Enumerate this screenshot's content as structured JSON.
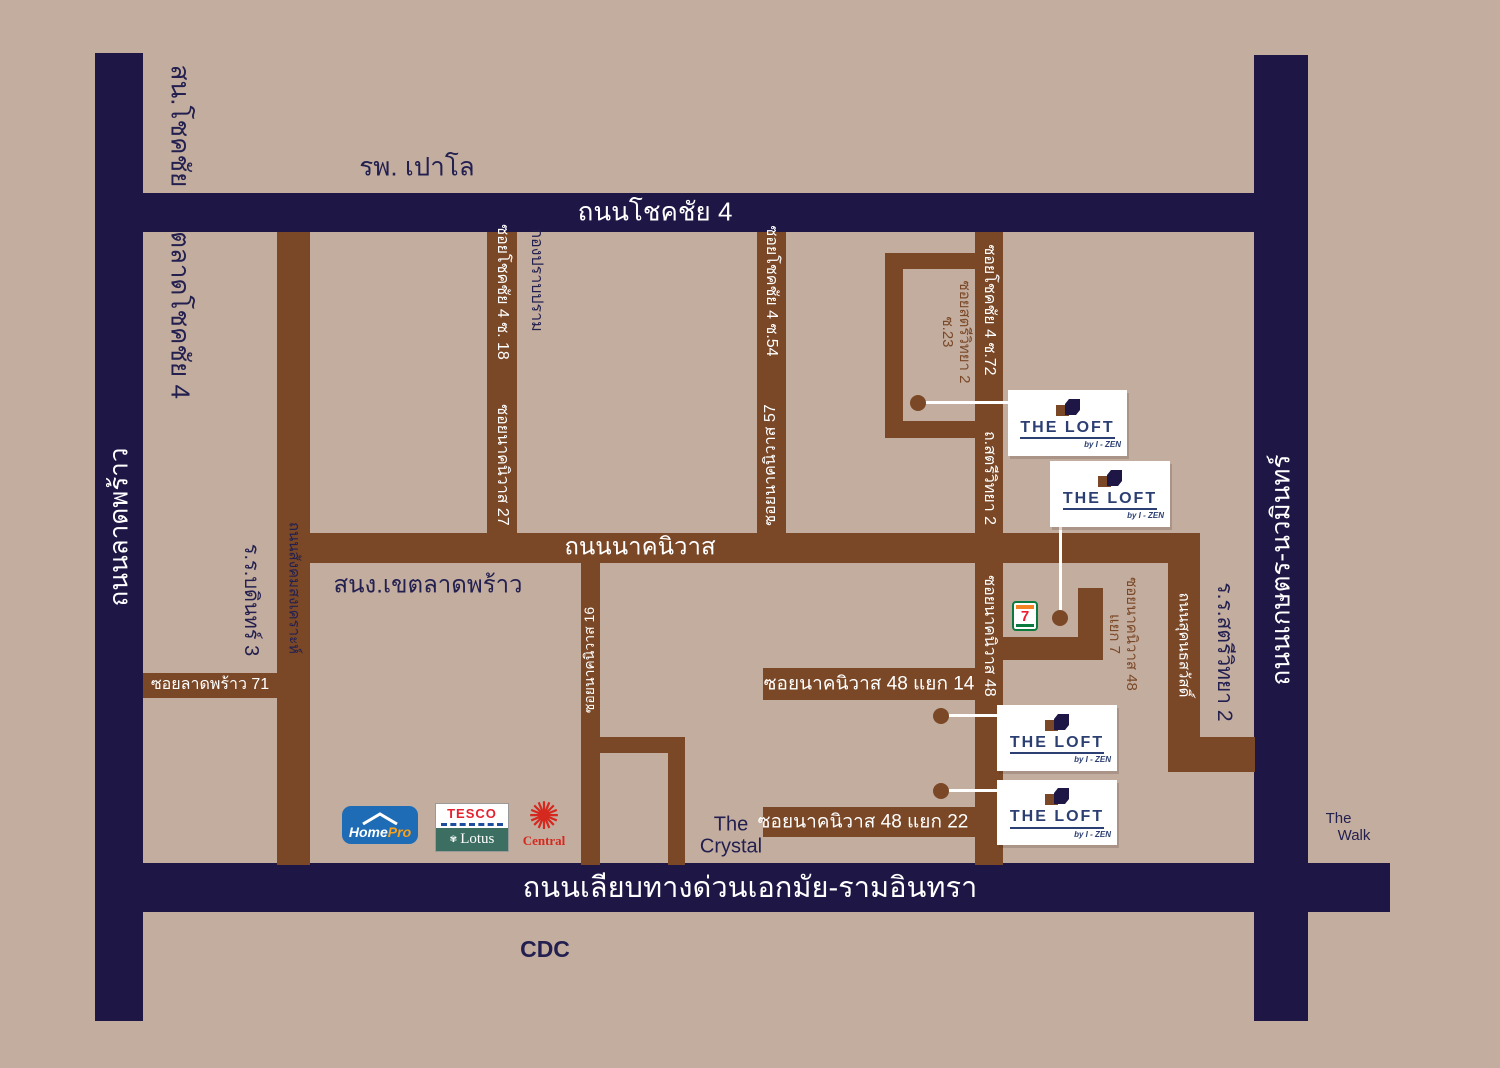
{
  "colors": {
    "bg": "#c3ad9f",
    "navy": "#1e1645",
    "brown": "#7a4827",
    "text_navy": "#232050",
    "loft_navy": "#2c3f72",
    "homepro_blue": "#1e6cb5",
    "homepro_orange": "#f9a11b",
    "tesco_red": "#e6212e",
    "tesco_blue": "#1c4e9d",
    "lotus_green": "#3c6f62",
    "central_red": "#d5281e",
    "seven_green": "#0b7a3e",
    "seven_orange": "#f58220",
    "seven_red": "#ee1c2e"
  },
  "roads": {
    "chokchai4": "ถนนโชคชัย  4",
    "ladprao": "ถนนลาดพร้าว",
    "kaset_nawamin": "ถนนเกษตร-นวมินทร์",
    "ekamai_ramindra": "ถนนเลียบทางด่วนเอกมัย-รามอินทรา",
    "nakniwat": "ถนนนาคนิวาส",
    "sangkhomsongkhro": "ถนนสังคมสงเคราะห์",
    "sukhonthasawat": "ถนนสุคนธสวัสดิ์",
    "soi_ladprao71": "ซอยลาดพร้าว 71",
    "soi_chokchai4_18": "ซอยโชคชัย 4 ซ. 18",
    "soi_chokchai4_54": "ซอยโชคชัย 4 ซ.54",
    "soi_chokchai4_72": "ซอยโชคชัย 4 ซ.72",
    "soi_nakniwat_16": "ซอยนาคนิวาส 16",
    "soi_nakniwat_27": "ซอยนาคนิวาส 27",
    "soi_nakniwat_48": "ซอยนาคนิวาส 48",
    "soi_nakniwat_57": "ซอยนาคนิวาส 57",
    "th_satriwitthaya2": "ถ.สตรีวิทยา 2",
    "soi_satriwitthaya2": {
      "line1": "ซอยสตรีวิทยา 2",
      "line2": "ซ.23"
    },
    "soi_nakniwat48_yaek7": {
      "line1": "ซอยนาคนิวาส 48",
      "line2": "แยก 7"
    },
    "soi_nakniwat48_yaek14": "ซอยนาคนิวาส 48 แยก 14",
    "soi_nakniwat48_yaek22": "ซอยนาคนิวาส 48 แยก 22"
  },
  "places": {
    "police_station": "สน.โชคชัย",
    "talad_chokchai4": "ตลาดโชคชัย 4",
    "paolo_hospital": "รพ. เปาโล",
    "crime_suppression": "กองปราบปราม",
    "bodin3_school": "ร.ร.บดินทร์ 3",
    "ladprao_district_office": "สนง.เขตลาดพร้าว",
    "satriwitthaya2_school": "ร.ร.สตรีวิทยา 2",
    "the_crystal": {
      "line1": "The",
      "line2": "Crystal"
    },
    "the_walk": {
      "line1": "The",
      "line2": "Walk"
    },
    "cdc": "CDC"
  },
  "loft": {
    "title": "THE  LOFT",
    "byline": "by  I - ZEN"
  },
  "brands": {
    "homepro": {
      "home": "Home",
      "pro": "Pro"
    },
    "tesco_lotus": {
      "tesco": "TESCO",
      "lotus": "Lotus",
      "flower": "✾"
    },
    "central": {
      "label": "Central",
      "flower": "✺"
    },
    "seven_eleven": {
      "digit": "7"
    }
  }
}
